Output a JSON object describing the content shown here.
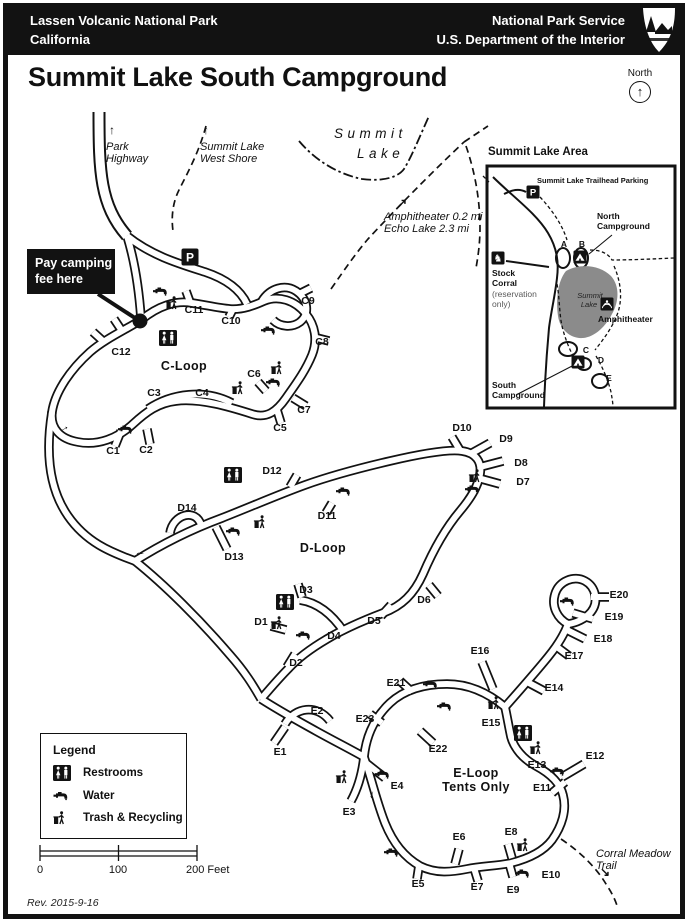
{
  "header": {
    "park": "Lassen Volcanic National Park",
    "state": "California",
    "agency": "National Park Service",
    "department": "U.S. Department of the Interior"
  },
  "title": "Summit Lake South Campground",
  "north": {
    "label": "North"
  },
  "fee_notice": {
    "line1": "Pay camping",
    "line2": "fee here"
  },
  "legend": {
    "title": "Legend",
    "items": [
      {
        "icon": "restrooms",
        "label": "Restrooms"
      },
      {
        "icon": "water",
        "label": "Water"
      },
      {
        "icon": "trash",
        "label": "Trash & Recycling"
      }
    ]
  },
  "scale": {
    "t0": "0",
    "t100": "100",
    "t200": "200 Feet"
  },
  "revision": "Rev. 2015-9-16",
  "inset": {
    "title": "Summit Lake Area"
  },
  "map": {
    "sites": [
      {
        "id": "C1",
        "x": 113,
        "y": 452
      },
      {
        "id": "C2",
        "x": 146,
        "y": 451
      },
      {
        "id": "C3",
        "x": 154,
        "y": 394
      },
      {
        "id": "C4",
        "x": 202,
        "y": 394
      },
      {
        "id": "C5",
        "x": 280,
        "y": 429
      },
      {
        "id": "C6",
        "x": 254,
        "y": 375
      },
      {
        "id": "C7",
        "x": 304,
        "y": 411
      },
      {
        "id": "C8",
        "x": 322,
        "y": 343
      },
      {
        "id": "C9",
        "x": 308,
        "y": 302
      },
      {
        "id": "C10",
        "x": 231,
        "y": 322
      },
      {
        "id": "C11",
        "x": 194,
        "y": 311
      },
      {
        "id": "C12",
        "x": 121,
        "y": 353
      },
      {
        "id": "D1",
        "x": 261,
        "y": 623
      },
      {
        "id": "D2",
        "x": 296,
        "y": 664
      },
      {
        "id": "D3",
        "x": 306,
        "y": 591
      },
      {
        "id": "D4",
        "x": 334,
        "y": 637
      },
      {
        "id": "D5",
        "x": 374,
        "y": 622
      },
      {
        "id": "D6",
        "x": 424,
        "y": 601
      },
      {
        "id": "D7",
        "x": 523,
        "y": 483
      },
      {
        "id": "D8",
        "x": 521,
        "y": 464
      },
      {
        "id": "D9",
        "x": 506,
        "y": 440
      },
      {
        "id": "D10",
        "x": 462,
        "y": 429
      },
      {
        "id": "D11",
        "x": 327,
        "y": 517
      },
      {
        "id": "D12",
        "x": 272,
        "y": 472
      },
      {
        "id": "D13",
        "x": 234,
        "y": 558
      },
      {
        "id": "D14",
        "x": 187,
        "y": 509
      },
      {
        "id": "E1",
        "x": 280,
        "y": 753
      },
      {
        "id": "E2",
        "x": 317,
        "y": 712
      },
      {
        "id": "E3",
        "x": 349,
        "y": 813
      },
      {
        "id": "E4",
        "x": 397,
        "y": 787
      },
      {
        "id": "E5",
        "x": 418,
        "y": 885
      },
      {
        "id": "E6",
        "x": 459,
        "y": 838
      },
      {
        "id": "E7",
        "x": 477,
        "y": 888
      },
      {
        "id": "E8",
        "x": 511,
        "y": 833
      },
      {
        "id": "E9",
        "x": 513,
        "y": 891
      },
      {
        "id": "E10",
        "x": 551,
        "y": 876
      },
      {
        "id": "E11",
        "x": 542,
        "y": 789
      },
      {
        "id": "E12",
        "x": 595,
        "y": 757
      },
      {
        "id": "E13",
        "x": 537,
        "y": 766
      },
      {
        "id": "E14",
        "x": 554,
        "y": 689
      },
      {
        "id": "E15",
        "x": 491,
        "y": 724
      },
      {
        "id": "E16",
        "x": 480,
        "y": 652
      },
      {
        "id": "E17",
        "x": 574,
        "y": 657
      },
      {
        "id": "E18",
        "x": 603,
        "y": 640
      },
      {
        "id": "E19",
        "x": 614,
        "y": 618
      },
      {
        "id": "E20",
        "x": 619,
        "y": 596
      },
      {
        "id": "E21",
        "x": 396,
        "y": 684
      },
      {
        "id": "E22",
        "x": 438,
        "y": 750
      },
      {
        "id": "E23",
        "x": 365,
        "y": 720
      }
    ],
    "icons": [
      {
        "t": "restrooms",
        "x": 168,
        "y": 338
      },
      {
        "t": "restrooms",
        "x": 233,
        "y": 475
      },
      {
        "t": "restrooms",
        "x": 285,
        "y": 602
      },
      {
        "t": "restrooms",
        "x": 523,
        "y": 733
      },
      {
        "t": "water",
        "x": 160,
        "y": 292
      },
      {
        "t": "water",
        "x": 268,
        "y": 331
      },
      {
        "t": "water",
        "x": 273,
        "y": 383
      },
      {
        "t": "water",
        "x": 125,
        "y": 430
      },
      {
        "t": "water",
        "x": 233,
        "y": 532
      },
      {
        "t": "water",
        "x": 343,
        "y": 492
      },
      {
        "t": "water",
        "x": 472,
        "y": 490
      },
      {
        "t": "water",
        "x": 303,
        "y": 636
      },
      {
        "t": "water",
        "x": 430,
        "y": 685
      },
      {
        "t": "water",
        "x": 444,
        "y": 707
      },
      {
        "t": "water",
        "x": 382,
        "y": 775
      },
      {
        "t": "water",
        "x": 567,
        "y": 602
      },
      {
        "t": "water",
        "x": 557,
        "y": 772
      },
      {
        "t": "water",
        "x": 522,
        "y": 874
      },
      {
        "t": "water",
        "x": 391,
        "y": 853
      },
      {
        "t": "trash",
        "x": 172,
        "y": 303
      },
      {
        "t": "trash",
        "x": 238,
        "y": 388
      },
      {
        "t": "trash",
        "x": 277,
        "y": 368
      },
      {
        "t": "trash",
        "x": 260,
        "y": 522
      },
      {
        "t": "trash",
        "x": 475,
        "y": 476
      },
      {
        "t": "trash",
        "x": 277,
        "y": 623
      },
      {
        "t": "trash",
        "x": 494,
        "y": 703
      },
      {
        "t": "trash",
        "x": 536,
        "y": 748
      },
      {
        "t": "trash",
        "x": 342,
        "y": 777
      },
      {
        "t": "trash",
        "x": 523,
        "y": 845
      },
      {
        "t": "parking",
        "x": 190,
        "y": 257
      },
      {
        "t": "parking_sm",
        "x": 533,
        "y": 192
      },
      {
        "t": "tent",
        "x": 580,
        "y": 257
      },
      {
        "t": "tent",
        "x": 578,
        "y": 362
      },
      {
        "t": "amphi",
        "x": 607,
        "y": 304
      },
      {
        "t": "horse",
        "x": 498,
        "y": 258
      }
    ],
    "labels": [
      {
        "cls": "tarrow",
        "a": "l",
        "x": 109,
        "y": 124,
        "text": "↑"
      },
      {
        "cls": "trail",
        "a": "l",
        "x": 106,
        "y": 141,
        "lines": [
          "Park",
          "Highway"
        ]
      },
      {
        "cls": "tarrow",
        "a": "l",
        "x": 203,
        "y": 124,
        "text": "↑"
      },
      {
        "cls": "trail",
        "a": "l",
        "x": 200,
        "y": 141,
        "lines": [
          "Summit Lake",
          "West Shore"
        ]
      },
      {
        "cls": "lake",
        "a": "l",
        "x": 334,
        "y": 126,
        "text": "Summit"
      },
      {
        "cls": "lake",
        "a": "l",
        "x": 357,
        "y": 146,
        "text": "Lake"
      },
      {
        "cls": "tarrow",
        "a": "l",
        "x": 397,
        "y": 197,
        "text": "↗"
      },
      {
        "cls": "trail",
        "a": "l",
        "x": 384,
        "y": 211,
        "lines": [
          "Amphitheater 0.2 mi",
          "Echo Lake 2.3 mi"
        ]
      },
      {
        "cls": "trail",
        "a": "l",
        "x": 596,
        "y": 848,
        "lines": [
          "Corral Meadow",
          "Trail"
        ]
      },
      {
        "cls": "tarrow",
        "a": "l",
        "x": 600,
        "y": 866,
        "text": "↘"
      },
      {
        "cls": "loop",
        "x": 184,
        "y": 366,
        "text": "C-Loop"
      },
      {
        "cls": "loop",
        "x": 323,
        "y": 548,
        "text": "D-Loop"
      },
      {
        "cls": "loop",
        "x": 476,
        "y": 780,
        "lines": [
          "E-Loop",
          "Tents Only"
        ]
      },
      {
        "cls": "inst",
        "a": "l",
        "x": 537,
        "y": 177,
        "text": "Summit Lake Trailhead Parking"
      },
      {
        "cls": "insb",
        "a": "l",
        "x": 597,
        "y": 212,
        "lines": [
          "North",
          "Campground"
        ]
      },
      {
        "cls": "insb",
        "a": "l",
        "x": 492,
        "y": 269,
        "lines": [
          "Stock",
          "Corral"
        ]
      },
      {
        "cls": "insg",
        "a": "l",
        "x": 492,
        "y": 290,
        "lines": [
          "(reservation",
          "only)"
        ]
      },
      {
        "cls": "insb",
        "a": "l",
        "x": 598,
        "y": 315,
        "text": "Amphitheater"
      },
      {
        "cls": "insb",
        "a": "l",
        "x": 492,
        "y": 381,
        "lines": [
          "South",
          "Campground"
        ]
      },
      {
        "cls": "insl",
        "x": 564,
        "y": 245,
        "text": "A"
      },
      {
        "cls": "insl",
        "x": 582,
        "y": 245,
        "text": "B"
      },
      {
        "cls": "insl",
        "x": 586,
        "y": 351,
        "text": "C"
      },
      {
        "cls": "insl",
        "x": 601,
        "y": 361,
        "text": "D"
      },
      {
        "cls": "insl",
        "x": 609,
        "y": 379,
        "text": "E"
      },
      {
        "cls": "insi",
        "x": 590,
        "y": 296,
        "text": "Summit"
      },
      {
        "cls": "insi",
        "x": 589,
        "y": 305,
        "text": "Lake"
      }
    ],
    "arrows": [
      {
        "x": 64,
        "y": 428,
        "r": -30
      },
      {
        "x": 140,
        "y": 555,
        "r": 180
      },
      {
        "x": 430,
        "y": 747,
        "r": 225
      },
      {
        "x": 373,
        "y": 795,
        "r": 105
      }
    ]
  }
}
